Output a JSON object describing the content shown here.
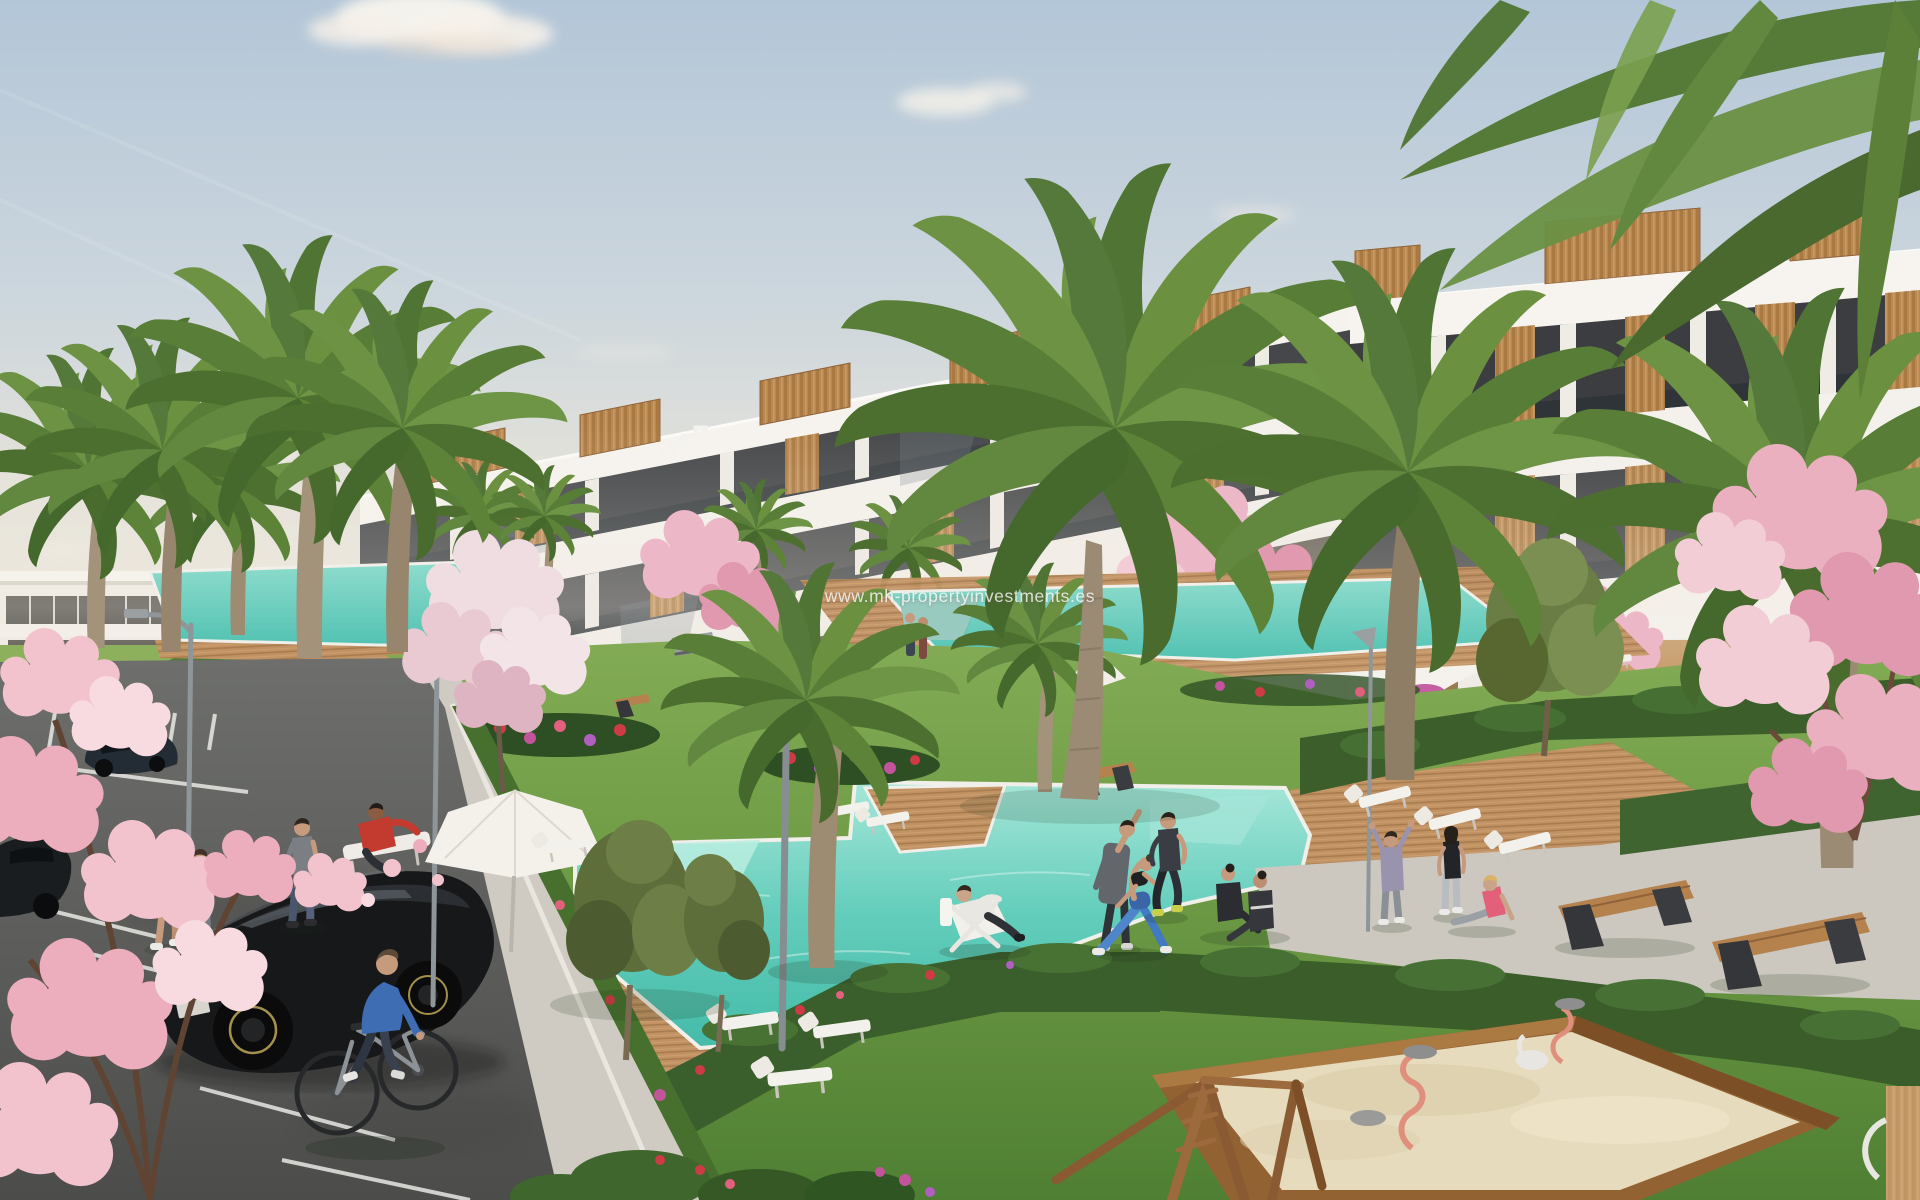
{
  "watermark": {
    "text": "www.mh-propertyinvestments.es"
  },
  "scene": {
    "setting": "sunny 3D architectural rendering of a modern white terraced apartment complex with communal pool gardens",
    "colors": {
      "sky_top": "#b3c6d8",
      "sky_horizon": "#f2ecdf",
      "building_white": "#f4f1ec",
      "glazing_dark": "#45474a",
      "wood_accent": "#b9874f",
      "pool_water": "#5fcdbb",
      "deck_wood": "#c19264",
      "lawn_green": "#6f9c46",
      "hedge_green": "#3b5e2b",
      "palm_green": "#5d8338",
      "blossom_pink": "#ecb7c6",
      "asphalt_gray": "#5f605d",
      "path_gray": "#cfcbc3",
      "sand_beige": "#e7dbbd",
      "flower_red": "#cf3b45",
      "flower_purple": "#b05fc0",
      "car_black": "#17181a",
      "cyclist_blue": "#3e6db4",
      "toy_salmon": "#df8f7c"
    },
    "objects": [
      "terraced-apartment-building",
      "distant-left-building",
      "swimming-pools",
      "wooden-pool-decks",
      "palm-trees",
      "cherry-blossom-trees",
      "hedges",
      "flower-beds",
      "lawns",
      "parking-lot",
      "parked-cars",
      "black-hatchback",
      "cyclist",
      "joggers",
      "walker-with-football",
      "people-exercising",
      "sun-loungers",
      "parasols",
      "street-lamps",
      "benches",
      "sandbox-playground",
      "spring-riders",
      "wooden-swing-frame",
      "clouds"
    ]
  }
}
